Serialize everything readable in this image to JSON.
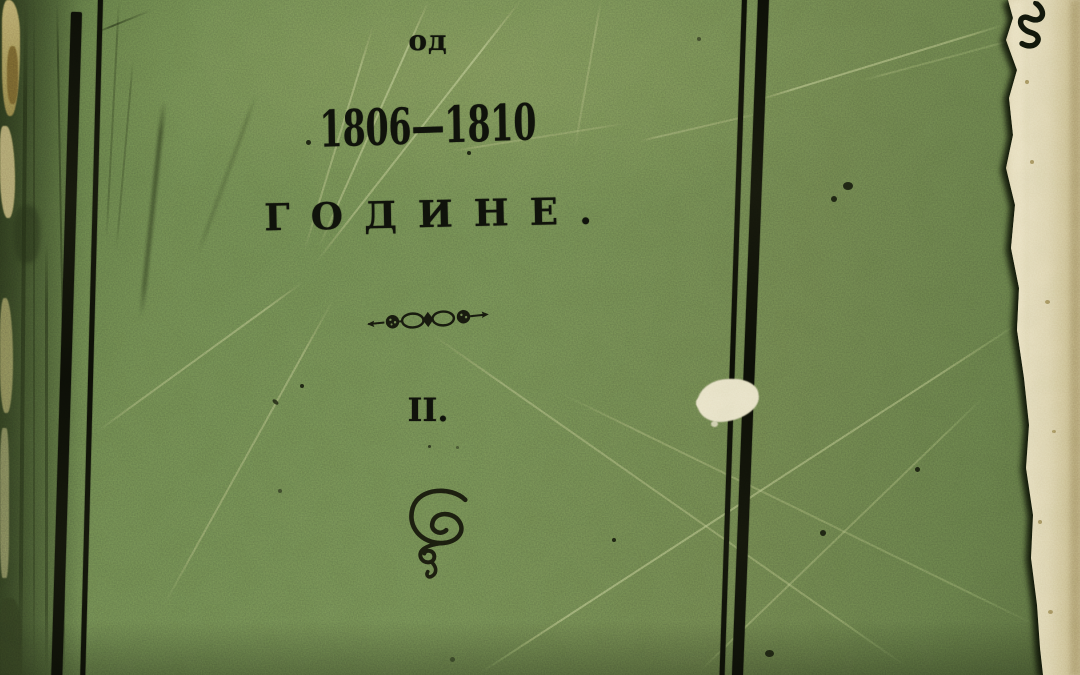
{
  "cover": {
    "preposition": "од",
    "year_range": "1806—1810",
    "title": "ГОДИНЕ.",
    "volume_numeral": "II."
  },
  "decorations": {
    "divider": "floral-infinity-vignette",
    "flourish": "spiral-pen-flourish",
    "damage": [
      "torn-paper-edge-right",
      "worn-spine-left",
      "white-patch",
      "ink-specks"
    ]
  },
  "colors": {
    "cover_green": "#66784A",
    "cover_green_dark": "#4A5C36",
    "cover_green_light": "#7D8F5C",
    "ink_black": "#0E100A",
    "paper_cream": "#DCD1AE",
    "spine_tan": "#A4904F",
    "shadow_dark": "#1A2410"
  }
}
